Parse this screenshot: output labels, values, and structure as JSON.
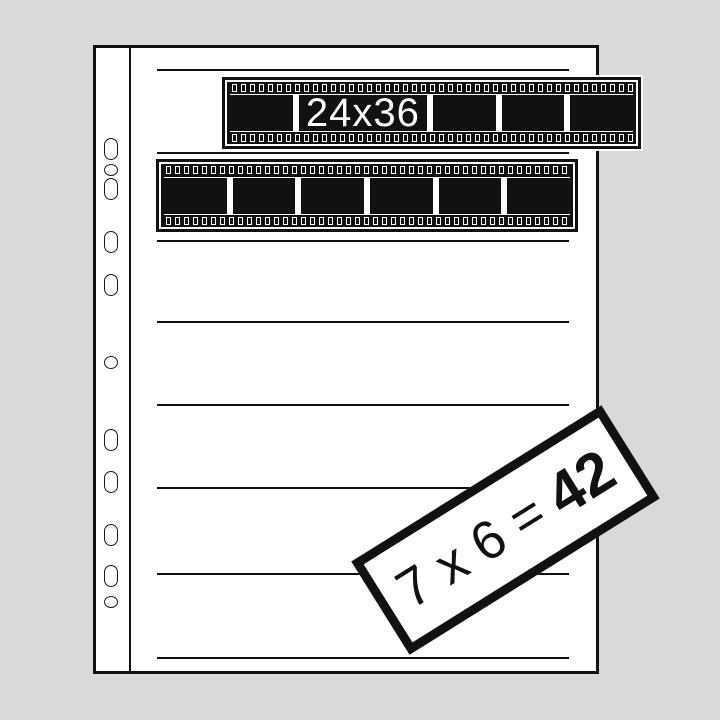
{
  "page": {
    "pockets": 7,
    "seam_lines": 8,
    "binder_holes": 11
  },
  "film_strips": [
    {
      "label": "24x36",
      "frames": 5,
      "format": "35mm"
    },
    {
      "label": "",
      "frames": 6,
      "format": "35mm"
    }
  ],
  "badge": {
    "expression": "7 x 6 =",
    "result": "42"
  },
  "colors": {
    "background": "#d9d9d9",
    "ink": "#111111",
    "paper": "#ffffff"
  }
}
